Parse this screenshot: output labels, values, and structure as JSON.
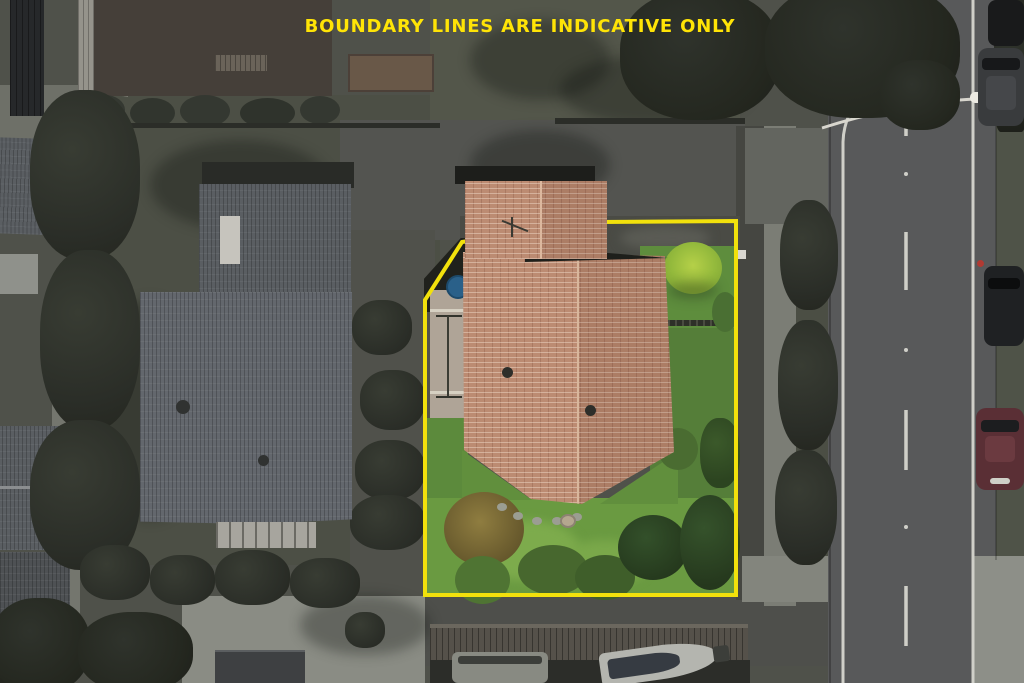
{
  "annotation": {
    "text": "BOUNDARY LINES ARE INDICATIVE ONLY",
    "color": "#ffe406"
  },
  "boundary": {
    "color": "#f2e10c",
    "width_px": 4,
    "points": "462,242 600,222 736,221 736,595 425,595 425,300"
  },
  "scene": {
    "type": "aerial-photograph",
    "effect": "surroundings desaturated, highlighted lot shown in full colour",
    "lot": {
      "house_roof_color": "#bc8b72",
      "lawn_color": "#679640",
      "flax_bush_color": "#b5d048",
      "concrete_path_color": "#afa497"
    },
    "neighbor": {
      "gray_roof_color": "#5e6266",
      "deck_color": "#a7a59e"
    },
    "road": {
      "surface_color": "#58595a",
      "marking_color": "#cfcfc8",
      "markings": [
        "left edge line",
        "centre dashed line",
        "right edge line"
      ],
      "streetlight": "arm crossing road with white lamp head"
    },
    "parked_cars": [
      {
        "position": "top-right",
        "color": "#191a1b"
      },
      {
        "position": "upper-right",
        "color": "#393b3d"
      },
      {
        "position": "mid-right",
        "color": "#1f2123"
      },
      {
        "position": "lower-right",
        "color": "#5a2f35"
      }
    ],
    "bottom": {
      "carport_color": "#55514a",
      "boat_hull_color": "#b4b5af",
      "boat_cover_color": "#363b42"
    }
  }
}
